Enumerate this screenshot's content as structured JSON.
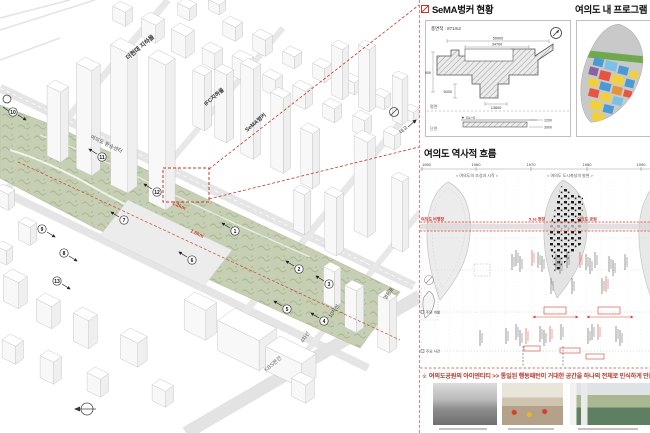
{
  "axon": {
    "labels": {
      "hyundai": "더현대 지하몰",
      "ifc": "IFC지하몰",
      "sema": "SeMA벙커",
      "transfer": "여의도 환승센터",
      "kbs": "KBS본관",
      "lane10": "10차선",
      "lane4": "4차선",
      "ydp": "영등포",
      "bridge": "대교",
      "d12": "1.2km",
      "d16": "1.6km"
    },
    "markers": [
      "1",
      "2",
      "3",
      "4",
      "5",
      "6",
      "7",
      "8",
      "9",
      "10",
      "11",
      "12",
      "13"
    ]
  },
  "sema": {
    "title": "SeMA벙커 현황",
    "area": "총면적 : 871m2",
    "plan_label": "평면",
    "section_label": "단면",
    "gl_label": "▼ GL+0",
    "dims": [
      "50000",
      "34700",
      "11900",
      "5000",
      "13600"
    ],
    "sdims": [
      "1200",
      "3000"
    ]
  },
  "program": {
    "title": "여의도 내 프로그램"
  },
  "history": {
    "title": "여의도 역사적 흐름",
    "years": [
      "1950",
      "1960",
      "1970",
      "1980",
      "1990"
    ],
    "phases": [
      "< 여의도의 조성과 시작 >",
      "< 여의도 도시축성의 발현 >"
    ],
    "band_labels": [
      "여의도 비행장",
      "5.16 광장",
      "여의도 공원"
    ],
    "row_labels": [
      "주요 개발",
      "주요 사건"
    ]
  },
  "footer": {
    "caption_prefix": "※",
    "caption": "여의도공원의 아이덴티티 >> 통일된 행동패턴이 거대한 공간을 하나의 전체로 인식하게 만듦"
  },
  "colors": {
    "accent_red": "#c0392b",
    "park_green": "#c6cfb4"
  }
}
